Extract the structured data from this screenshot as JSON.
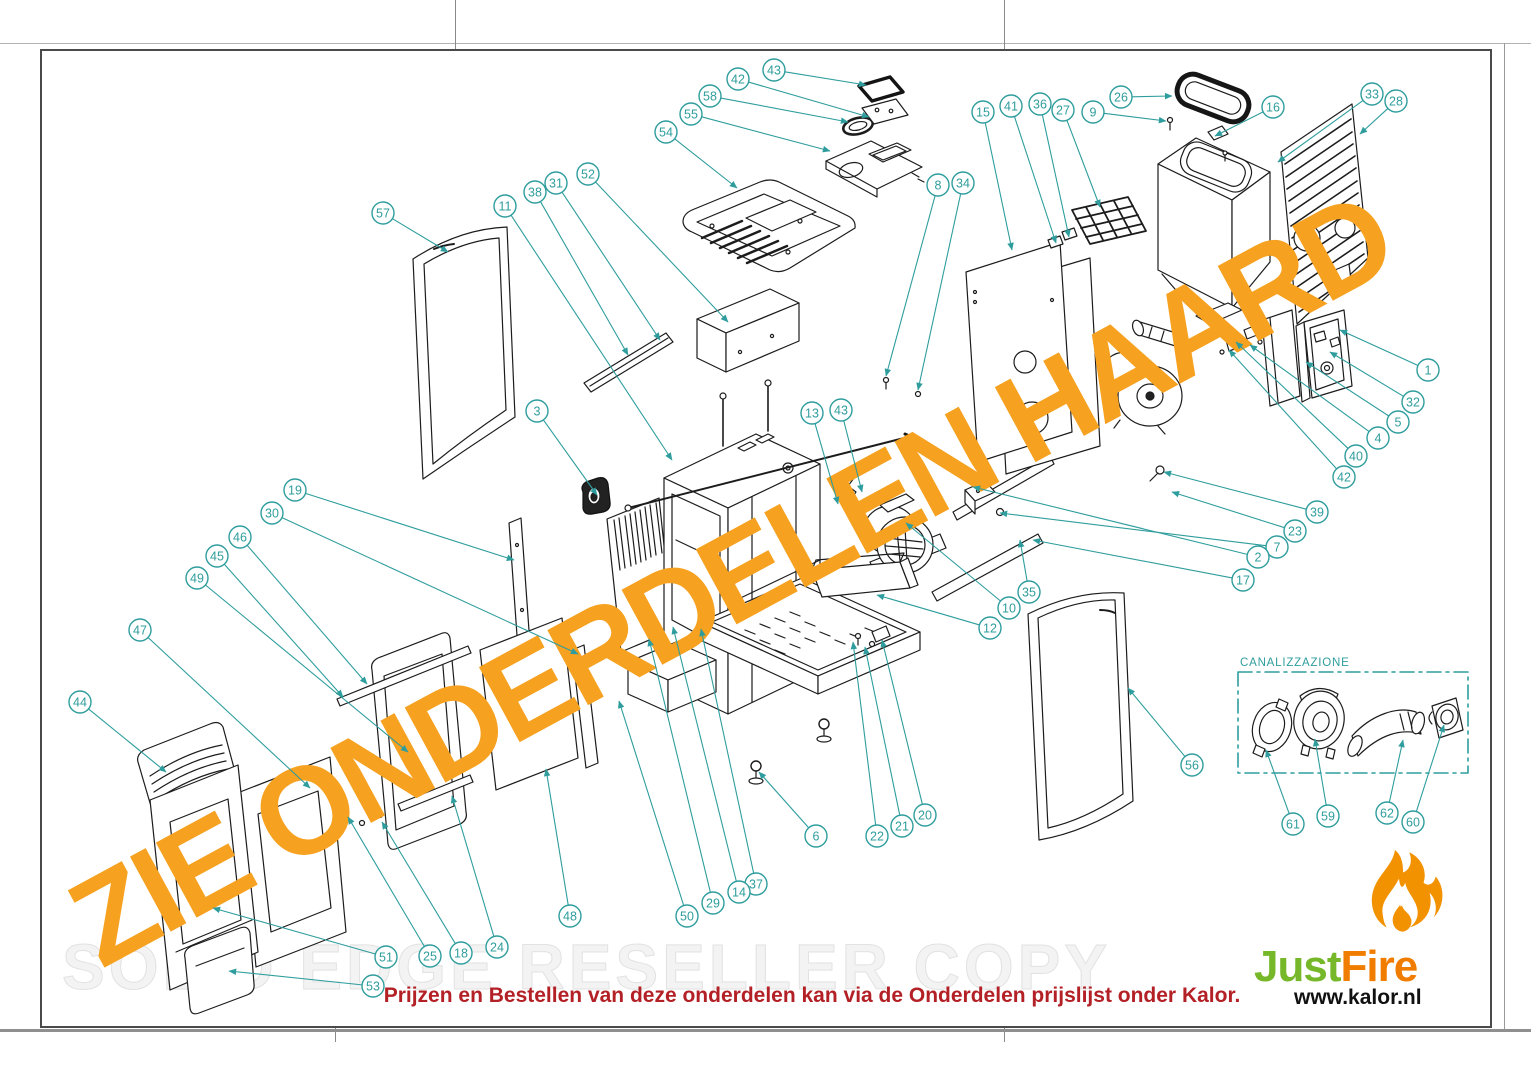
{
  "sheet": {
    "canalizzazione_label": "CANALIZZAZIONE"
  },
  "watermarks": {
    "orange": "ZIE ONDERDELEN HAARD",
    "gray": "SOLID EDGE RESELLER COPY"
  },
  "footer": {
    "note": "Prijzen en Bestellen van deze onderdelen kan via de Onderdelen prijslijst onder Kalor."
  },
  "logo": {
    "just": "Just",
    "fire": "Fire",
    "url": "www.kalor.nl"
  },
  "colors": {
    "callout": "#2f9d9d",
    "watermark_orange": "#f6a11f",
    "watermark_gray": "#ededed",
    "note_red": "#b32025",
    "logo_green": "#76b82a",
    "logo_orange": "#f07d00",
    "flame": "#f39200",
    "line": "#1c1c1c"
  },
  "callouts": [
    {
      "n": "57",
      "x": 383,
      "y": 213,
      "tx": 448,
      "ty": 252
    },
    {
      "n": "11",
      "x": 505,
      "y": 206,
      "tx": 672,
      "ty": 460
    },
    {
      "n": "38",
      "x": 535,
      "y": 192,
      "tx": 628,
      "ty": 355
    },
    {
      "n": "31",
      "x": 556,
      "y": 183,
      "tx": 660,
      "ty": 340
    },
    {
      "n": "52",
      "x": 588,
      "y": 174,
      "tx": 728,
      "ty": 322
    },
    {
      "n": "54",
      "x": 666,
      "y": 132,
      "tx": 737,
      "ty": 188
    },
    {
      "n": "55",
      "x": 691,
      "y": 114,
      "tx": 830,
      "ty": 151
    },
    {
      "n": "58",
      "x": 710,
      "y": 96,
      "tx": 848,
      "ty": 122
    },
    {
      "n": "42",
      "x": 738,
      "y": 79,
      "tx": 869,
      "ty": 117
    },
    {
      "n": "43",
      "x": 774,
      "y": 70,
      "tx": 866,
      "ty": 85
    },
    {
      "n": "15",
      "x": 983,
      "y": 112,
      "tx": 1012,
      "ty": 250
    },
    {
      "n": "41",
      "x": 1011,
      "y": 106,
      "tx": 1056,
      "ty": 243
    },
    {
      "n": "36",
      "x": 1040,
      "y": 104,
      "tx": 1069,
      "ty": 237
    },
    {
      "n": "27",
      "x": 1063,
      "y": 110,
      "tx": 1100,
      "ty": 207
    },
    {
      "n": "9",
      "x": 1093,
      "y": 112,
      "tx": 1166,
      "ty": 121
    },
    {
      "n": "26",
      "x": 1121,
      "y": 97,
      "tx": 1172,
      "ty": 96
    },
    {
      "n": "16",
      "x": 1273,
      "y": 107,
      "tx": 1215,
      "ty": 136
    },
    {
      "n": "33",
      "x": 1372,
      "y": 94,
      "tx": 1278,
      "ty": 162
    },
    {
      "n": "28",
      "x": 1396,
      "y": 101,
      "tx": 1360,
      "ty": 134
    },
    {
      "n": "8",
      "x": 938,
      "y": 185,
      "tx": 886,
      "ty": 376
    },
    {
      "n": "34",
      "x": 963,
      "y": 183,
      "tx": 918,
      "ty": 390
    },
    {
      "n": "1",
      "x": 1428,
      "y": 370,
      "tx": 1340,
      "ty": 330
    },
    {
      "n": "32",
      "x": 1413,
      "y": 402,
      "tx": 1330,
      "ty": 352
    },
    {
      "n": "5",
      "x": 1398,
      "y": 422,
      "tx": 1306,
      "ty": 362
    },
    {
      "n": "4",
      "x": 1378,
      "y": 438,
      "tx": 1250,
      "ty": 345
    },
    {
      "n": "40",
      "x": 1356,
      "y": 456,
      "tx": 1236,
      "ty": 342
    },
    {
      "n": "42",
      "x": 1344,
      "y": 477,
      "tx": 1229,
      "ty": 350
    },
    {
      "n": "39",
      "x": 1317,
      "y": 512,
      "tx": 1164,
      "ty": 472
    },
    {
      "n": "23",
      "x": 1295,
      "y": 531,
      "tx": 1172,
      "ty": 492
    },
    {
      "n": "7",
      "x": 1277,
      "y": 547,
      "tx": 1000,
      "ty": 513
    },
    {
      "n": "2",
      "x": 1258,
      "y": 557,
      "tx": 973,
      "ty": 487
    },
    {
      "n": "17",
      "x": 1243,
      "y": 580,
      "tx": 1033,
      "ty": 540
    },
    {
      "n": "13",
      "x": 812,
      "y": 413,
      "tx": 838,
      "ty": 504
    },
    {
      "n": "43",
      "x": 841,
      "y": 410,
      "tx": 862,
      "ty": 492
    },
    {
      "n": "3",
      "x": 537,
      "y": 411,
      "tx": 597,
      "ty": 495
    },
    {
      "n": "19",
      "x": 295,
      "y": 490,
      "tx": 514,
      "ty": 560
    },
    {
      "n": "30",
      "x": 272,
      "y": 513,
      "tx": 578,
      "ty": 654
    },
    {
      "n": "46",
      "x": 240,
      "y": 537,
      "tx": 367,
      "ty": 684
    },
    {
      "n": "45",
      "x": 217,
      "y": 556,
      "tx": 343,
      "ty": 697
    },
    {
      "n": "49",
      "x": 197,
      "y": 578,
      "tx": 408,
      "ty": 752
    },
    {
      "n": "47",
      "x": 140,
      "y": 630,
      "tx": 310,
      "ty": 788
    },
    {
      "n": "44",
      "x": 80,
      "y": 702,
      "tx": 166,
      "ty": 772
    },
    {
      "n": "35",
      "x": 1029,
      "y": 592,
      "tx": 1020,
      "ty": 540
    },
    {
      "n": "10",
      "x": 1009,
      "y": 608,
      "tx": 906,
      "ty": 523
    },
    {
      "n": "12",
      "x": 990,
      "y": 628,
      "tx": 877,
      "ty": 595
    },
    {
      "n": "56",
      "x": 1192,
      "y": 765,
      "tx": 1128,
      "ty": 688
    },
    {
      "n": "6",
      "x": 816,
      "y": 836,
      "tx": 759,
      "ty": 772
    },
    {
      "n": "22",
      "x": 877,
      "y": 836,
      "tx": 853,
      "ty": 642
    },
    {
      "n": "21",
      "x": 902,
      "y": 826,
      "tx": 865,
      "ty": 647
    },
    {
      "n": "20",
      "x": 925,
      "y": 815,
      "tx": 882,
      "ty": 640
    },
    {
      "n": "37",
      "x": 756,
      "y": 884,
      "tx": 701,
      "ty": 629
    },
    {
      "n": "14",
      "x": 739,
      "y": 892,
      "tx": 673,
      "ty": 627
    },
    {
      "n": "29",
      "x": 713,
      "y": 903,
      "tx": 649,
      "ty": 639
    },
    {
      "n": "50",
      "x": 687,
      "y": 916,
      "tx": 619,
      "ty": 701
    },
    {
      "n": "48",
      "x": 570,
      "y": 916,
      "tx": 546,
      "ty": 769
    },
    {
      "n": "24",
      "x": 497,
      "y": 947,
      "tx": 452,
      "ty": 796
    },
    {
      "n": "18",
      "x": 461,
      "y": 953,
      "tx": 382,
      "ty": 822
    },
    {
      "n": "25",
      "x": 430,
      "y": 956,
      "tx": 348,
      "ty": 817
    },
    {
      "n": "51",
      "x": 386,
      "y": 957,
      "tx": 213,
      "ty": 908
    },
    {
      "n": "53",
      "x": 373,
      "y": 986,
      "tx": 229,
      "ty": 971
    },
    {
      "n": "61",
      "x": 1293,
      "y": 824,
      "tx": 1266,
      "ty": 750
    },
    {
      "n": "59",
      "x": 1328,
      "y": 816,
      "tx": 1315,
      "ty": 739
    },
    {
      "n": "62",
      "x": 1387,
      "y": 813,
      "tx": 1403,
      "ty": 740
    },
    {
      "n": "60",
      "x": 1413,
      "y": 822,
      "tx": 1444,
      "ty": 725
    }
  ]
}
